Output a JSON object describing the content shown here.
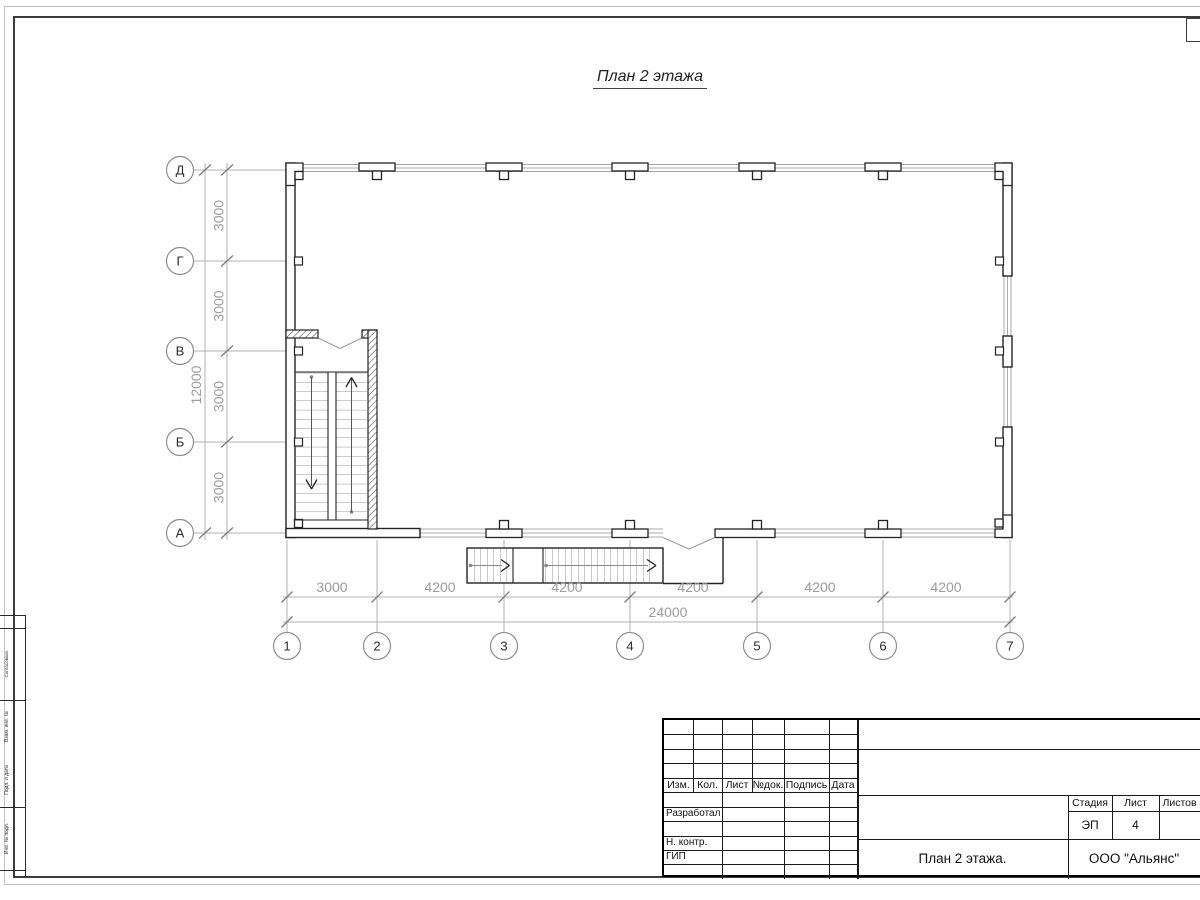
{
  "title": "План 2 этажа",
  "plan": {
    "row_axes": [
      "Д",
      "Г",
      "В",
      "Б",
      "А"
    ],
    "col_axes": [
      "1",
      "2",
      "3",
      "4",
      "5",
      "6",
      "7"
    ],
    "v_dims": [
      "3000",
      "3000",
      "3000",
      "3000"
    ],
    "v_total": "12000",
    "h_dims": [
      "3000",
      "4200",
      "4200",
      "4200",
      "4200",
      "4200"
    ],
    "h_total": "24000"
  },
  "margin_stamp": {
    "labels": [
      "Согласовано",
      "Взам. инв. №",
      "Подп. и дата",
      "Инв. № подл."
    ]
  },
  "titleblock": {
    "col_headers": [
      "Изм.",
      "Кол.",
      "Лист",
      "№док.",
      "Подпись",
      "Дата"
    ],
    "row_labels": [
      "Разработал",
      "Н. контр.",
      "ГИП"
    ],
    "stage_label": "Стадия",
    "sheet_label": "Лист",
    "sheets_label": "Листов",
    "stage_value": "ЭП",
    "sheet_value": "4",
    "doc_title": "План 2 этажа.",
    "company": "ООО \"Альянс\""
  }
}
